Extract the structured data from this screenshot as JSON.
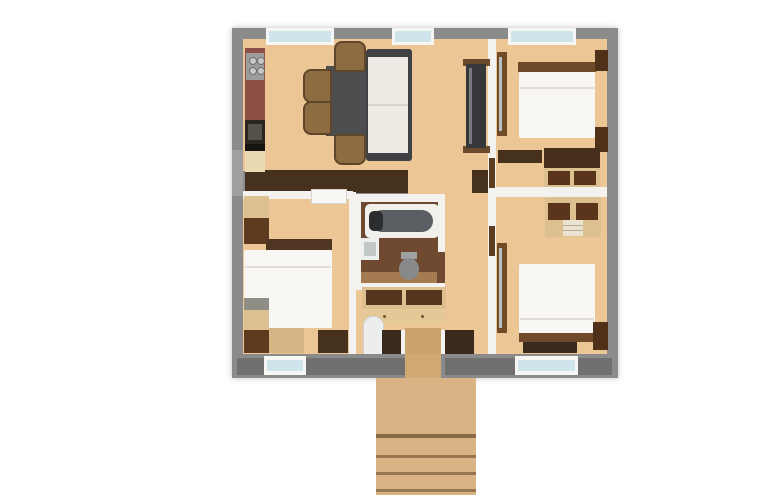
{
  "meta": {
    "image_kind": "3d-rendered-apartment-floor-plan",
    "rooms": [
      "living-dining-kitchen",
      "bedroom-top-right",
      "bedroom-bottom-right",
      "bedroom-bottom-left",
      "bathroom",
      "hallway",
      "entrance-deck"
    ]
  },
  "canvas": {
    "width": 781,
    "height": 502,
    "background": "#ffffff"
  },
  "palette": {
    "wallExt": "#8b8b8b",
    "wallInt": "#f3f2ee",
    "floorLight": "#ecc795",
    "floorBath": "#6f4a31",
    "bandDark": "#46311e",
    "woodDark": "#5e3a1f",
    "woodMid": "#8d6c42",
    "woodFrame": "#dcc08f",
    "woodDeck": "#d9b384",
    "white": "#f8f7f3",
    "glass": "#cfe3ea",
    "grayFurn": "#4b4d4f",
    "tvDark": "#35373a",
    "counterRed": "#8d5046",
    "mirror": "#b9c0c3",
    "stairLight": "#eceded"
  },
  "elements": [
    {
      "name": "exterior-wall",
      "x": 232,
      "y": 28,
      "w": 386,
      "h": 350,
      "fill": "wallExt",
      "shadow": "0 0 6px rgba(0,0,0,0.25)"
    },
    {
      "name": "left-wall-patch",
      "x": 232,
      "y": 150,
      "w": 11,
      "h": 46,
      "fill": "#a0a09e"
    },
    {
      "name": "living-room-floor",
      "x": 243,
      "y": 39,
      "w": 246,
      "h": 132,
      "fill": "floorLight",
      "tex": "planks-v"
    },
    {
      "name": "passage-living-hall-floor",
      "x": 408,
      "y": 168,
      "w": 64,
      "h": 28,
      "fill": "floorLight",
      "tex": "planks-v"
    },
    {
      "name": "corridor-floor",
      "x": 445,
      "y": 171,
      "w": 51,
      "h": 119,
      "fill": "floorLight",
      "tex": "planks-v"
    },
    {
      "name": "hall-floor",
      "x": 351,
      "y": 283,
      "w": 145,
      "h": 77,
      "fill": "floorLight",
      "tex": "planks-v"
    },
    {
      "name": "bedroom-top-right-floor",
      "x": 496,
      "y": 39,
      "w": 111,
      "h": 150,
      "fill": "floorLight",
      "tex": "planks-v"
    },
    {
      "name": "bedroom-bottom-right-floor",
      "x": 496,
      "y": 189,
      "w": 111,
      "h": 171,
      "fill": "floorLight",
      "tex": "planks-v"
    },
    {
      "name": "bedroom-bottom-left-floor",
      "x": 243,
      "y": 192,
      "w": 108,
      "h": 168,
      "fill": "floorLight",
      "tex": "planks-v"
    },
    {
      "name": "south-closet-band-living",
      "x": 245,
      "y": 170,
      "w": 163,
      "h": 23,
      "fill": "bandDark"
    },
    {
      "name": "south-closet-band-right",
      "x": 472,
      "y": 170,
      "w": 24,
      "h": 23,
      "fill": "bandDark"
    },
    {
      "name": "wall-bedroom-bottom-left-north",
      "x": 243,
      "y": 191,
      "w": 110,
      "h": 8,
      "fill": "wallInt"
    },
    {
      "name": "wall-bedroom-left-east",
      "x": 349,
      "y": 192,
      "w": 7,
      "h": 168,
      "fill": "wallInt"
    },
    {
      "name": "wall-living-east",
      "x": 488,
      "y": 39,
      "w": 8,
      "h": 321,
      "fill": "wallInt"
    },
    {
      "name": "wall-right-bedrooms-divider",
      "x": 496,
      "y": 187,
      "w": 111,
      "h": 10,
      "fill": "wallInt"
    },
    {
      "name": "kitchen-counter-tile",
      "x": 245,
      "y": 48,
      "w": 20,
      "h": 76,
      "fill": "counterRed",
      "tex": "speckle"
    },
    {
      "name": "cooktop",
      "x": 246,
      "y": 53,
      "w": 18,
      "h": 27,
      "fill": "#9d9d9b"
    },
    {
      "name": "cooktop-burner-1",
      "x": 249,
      "y": 57,
      "w": 6,
      "h": 6,
      "fill": "#c7c7c5",
      "br": "50%",
      "border": "1px solid #6e6e6c"
    },
    {
      "name": "cooktop-burner-2",
      "x": 257,
      "y": 57,
      "w": 6,
      "h": 6,
      "fill": "#c7c7c5",
      "br": "50%",
      "border": "1px solid #6e6e6c"
    },
    {
      "name": "cooktop-burner-3",
      "x": 249,
      "y": 67,
      "w": 6,
      "h": 6,
      "fill": "#c7c7c5",
      "br": "50%",
      "border": "1px solid #6e6e6c"
    },
    {
      "name": "cooktop-burner-4",
      "x": 257,
      "y": 67,
      "w": 6,
      "h": 6,
      "fill": "#c7c7c5",
      "br": "50%",
      "border": "1px solid #6e6e6c"
    },
    {
      "name": "kitchen-sink",
      "x": 245,
      "y": 120,
      "w": 20,
      "h": 24,
      "fill": "#2a2520"
    },
    {
      "name": "kitchen-sink-basin",
      "x": 248,
      "y": 124,
      "w": 14,
      "h": 16,
      "fill": "#55504a"
    },
    {
      "name": "kitchen-counter-dark",
      "x": 245,
      "y": 144,
      "w": 20,
      "h": 7,
      "fill": "#161310"
    },
    {
      "name": "kitchen-cabinet",
      "x": 245,
      "y": 151,
      "w": 20,
      "h": 21,
      "fill": "#ead9b2"
    },
    {
      "name": "dining-table",
      "x": 326,
      "y": 66,
      "w": 42,
      "h": 70,
      "fill": "grayFurn"
    },
    {
      "name": "dining-chair-top",
      "x": 334,
      "y": 41,
      "w": 28,
      "h": 27,
      "fill": "woodMid",
      "br": "8px 8px 3px 3px",
      "border": "2px solid #5f462a"
    },
    {
      "name": "dining-chair-left-1",
      "x": 303,
      "y": 69,
      "w": 25,
      "h": 30,
      "fill": "woodMid",
      "br": "8px 3px 3px 8px",
      "border": "2px solid #5f462a"
    },
    {
      "name": "dining-chair-left-2",
      "x": 303,
      "y": 101,
      "w": 25,
      "h": 30,
      "fill": "woodMid",
      "br": "8px 3px 3px 8px",
      "border": "2px solid #5f462a"
    },
    {
      "name": "dining-chair-bottom",
      "x": 334,
      "y": 134,
      "w": 28,
      "h": 27,
      "fill": "woodMid",
      "br": "3px 3px 8px 8px",
      "border": "2px solid #5f462a"
    },
    {
      "name": "sofa-frame",
      "x": 366,
      "y": 49,
      "w": 46,
      "h": 112,
      "fill": "#3f4144",
      "br": "3px"
    },
    {
      "name": "sofa-seat",
      "x": 368,
      "y": 57,
      "w": 40,
      "h": 96,
      "fill": "#edebe4"
    },
    {
      "name": "sofa-seam",
      "x": 368,
      "y": 104,
      "w": 40,
      "h": 2,
      "fill": "#d8d5cc"
    },
    {
      "name": "tv-console-shelf-top",
      "x": 463,
      "y": 59,
      "w": 27,
      "h": 7,
      "fill": "#6b4a2c"
    },
    {
      "name": "tv-console-shelf-bottom",
      "x": 463,
      "y": 146,
      "w": 27,
      "h": 7,
      "fill": "#6b4a2c"
    },
    {
      "name": "tv-console",
      "x": 466,
      "y": 64,
      "w": 20,
      "h": 84,
      "fill": "tvDark"
    },
    {
      "name": "tv-screen-glint",
      "x": 469,
      "y": 68,
      "w": 3,
      "h": 76,
      "fill": "#787c80"
    },
    {
      "name": "door-bedroom-top-right",
      "x": 489,
      "y": 158,
      "w": 6,
      "h": 30,
      "fill": "#5d3c20"
    },
    {
      "name": "door-bedroom-bottom-right",
      "x": 489,
      "y": 226,
      "w": 6,
      "h": 30,
      "fill": "#5d3c20"
    },
    {
      "name": "wardrobe-strip-top-right",
      "x": 497,
      "y": 52,
      "w": 10,
      "h": 84,
      "fill": "#6f4b28"
    },
    {
      "name": "wardrobe-mirror-top-right",
      "x": 499,
      "y": 57,
      "w": 3,
      "h": 74,
      "fill": "mirror"
    },
    {
      "name": "bed1-headboard",
      "x": 518,
      "y": 62,
      "w": 78,
      "h": 10,
      "fill": "#6f4a2a"
    },
    {
      "name": "bed1-mattress",
      "x": 519,
      "y": 72,
      "w": 76,
      "h": 66,
      "fill": "white",
      "br": "2px"
    },
    {
      "name": "bed1-pillow-seam",
      "x": 520,
      "y": 87,
      "w": 74,
      "h": 2,
      "fill": "#e0ddd4"
    },
    {
      "name": "bed1-nightstand-top",
      "x": 595,
      "y": 50,
      "w": 13,
      "h": 21,
      "fill": "#4e3118"
    },
    {
      "name": "bed1-nightstand-bottom",
      "x": 595,
      "y": 127,
      "w": 13,
      "h": 25,
      "fill": "#4e3118"
    },
    {
      "name": "cabinet-top-right-band",
      "x": 498,
      "y": 150,
      "w": 44,
      "h": 13,
      "fill": "bandDark"
    },
    {
      "name": "desk-top-right",
      "x": 544,
      "y": 148,
      "w": 56,
      "h": 20,
      "fill": "#46301c"
    },
    {
      "name": "desk-shelf-frame",
      "x": 544,
      "y": 168,
      "w": 56,
      "h": 19,
      "fill": "woodFrame"
    },
    {
      "name": "desk-shelf-left",
      "x": 548,
      "y": 171,
      "w": 22,
      "h": 14,
      "fill": "#5a341b"
    },
    {
      "name": "desk-shelf-right",
      "x": 574,
      "y": 171,
      "w": 22,
      "h": 14,
      "fill": "#5a341b"
    },
    {
      "name": "wardrobe2-frame",
      "x": 545,
      "y": 197,
      "w": 56,
      "h": 40,
      "fill": "woodFrame"
    },
    {
      "name": "wardrobe2-interior-left",
      "x": 548,
      "y": 203,
      "w": 22,
      "h": 17,
      "fill": "#5a341b"
    },
    {
      "name": "wardrobe2-interior-right",
      "x": 576,
      "y": 203,
      "w": 22,
      "h": 17,
      "fill": "#5a341b"
    },
    {
      "name": "wardrobe2-drawers",
      "x": 563,
      "y": 220,
      "w": 20,
      "h": 16,
      "fill": "#eae3d2"
    },
    {
      "name": "wardrobe2-drawer-line-1",
      "x": 563,
      "y": 225,
      "w": 20,
      "h": 1,
      "fill": "#b8ab90"
    },
    {
      "name": "wardrobe2-drawer-line-2",
      "x": 563,
      "y": 230,
      "w": 20,
      "h": 1,
      "fill": "#b8ab90"
    },
    {
      "name": "wardrobe-strip-bottom-right",
      "x": 497,
      "y": 243,
      "w": 10,
      "h": 90,
      "fill": "#6f4b28"
    },
    {
      "name": "wardrobe-mirror-bottom-right",
      "x": 499,
      "y": 248,
      "w": 3,
      "h": 80,
      "fill": "mirror"
    },
    {
      "name": "bed2-mattress",
      "x": 519,
      "y": 264,
      "w": 76,
      "h": 70,
      "fill": "white",
      "br": "2px"
    },
    {
      "name": "bed2-pillow-seam",
      "x": 520,
      "y": 318,
      "w": 74,
      "h": 2,
      "fill": "#e0ddd4"
    },
    {
      "name": "bed2-footboard",
      "x": 519,
      "y": 333,
      "w": 76,
      "h": 9,
      "fill": "#6f4a2a"
    },
    {
      "name": "bed2-bench",
      "x": 523,
      "y": 342,
      "w": 54,
      "h": 11,
      "fill": "#3a2a1c"
    },
    {
      "name": "bed2-nightstand",
      "x": 593,
      "y": 322,
      "w": 15,
      "h": 28,
      "fill": "#4e3118"
    },
    {
      "name": "wardrobe3-upper",
      "x": 244,
      "y": 196,
      "w": 25,
      "h": 22,
      "fill": "woodFrame"
    },
    {
      "name": "wardrobe3-lower",
      "x": 244,
      "y": 218,
      "w": 25,
      "h": 26,
      "fill": "#5e3a1f"
    },
    {
      "name": "door-bedroom-left",
      "x": 311,
      "y": 189,
      "w": 34,
      "h": 13,
      "fill": "white",
      "tex": "panels",
      "border": "1px solid #d9d6cf"
    },
    {
      "name": "bed3-headboard",
      "x": 266,
      "y": 239,
      "w": 66,
      "h": 11,
      "fill": "#4f3522"
    },
    {
      "name": "bed3-mattress",
      "x": 244,
      "y": 250,
      "w": 88,
      "h": 78,
      "fill": "white",
      "br": "2px"
    },
    {
      "name": "bed3-pillow-seam",
      "x": 245,
      "y": 266,
      "w": 86,
      "h": 2,
      "fill": "#e0ddd4"
    },
    {
      "name": "bed3-bench-light",
      "x": 266,
      "y": 328,
      "w": 38,
      "h": 25,
      "fill": "#d8b584"
    },
    {
      "name": "bed3-bench-dark",
      "x": 318,
      "y": 330,
      "w": 30,
      "h": 23,
      "fill": "#46311f"
    },
    {
      "name": "wardrobe4-top",
      "x": 244,
      "y": 298,
      "w": 25,
      "h": 12,
      "fill": "#8f8e86"
    },
    {
      "name": "wardrobe4-mid",
      "x": 244,
      "y": 310,
      "w": 25,
      "h": 20,
      "fill": "woodFrame"
    },
    {
      "name": "wardrobe4-low",
      "x": 244,
      "y": 330,
      "w": 25,
      "h": 23,
      "fill": "#5e3a1f"
    },
    {
      "name": "bathroom-walls",
      "x": 353,
      "y": 194,
      "w": 92,
      "h": 96,
      "fill": "wallInt"
    },
    {
      "name": "bathroom-floor",
      "x": 361,
      "y": 202,
      "w": 77,
      "h": 81,
      "fill": "floorBath",
      "tex": "planks-h"
    },
    {
      "name": "bathroom-floor-light",
      "x": 361,
      "y": 272,
      "w": 77,
      "h": 11,
      "fill": "#a57b52",
      "tex": "planks-h"
    },
    {
      "name": "bathtub",
      "x": 365,
      "y": 204,
      "w": 74,
      "h": 34,
      "fill": "#f1f0eb",
      "br": "5px"
    },
    {
      "name": "bathtub-basin",
      "x": 371,
      "y": 210,
      "w": 62,
      "h": 22,
      "fill": "#5b5e62",
      "br": "11px"
    },
    {
      "name": "bathtub-faucet",
      "x": 369,
      "y": 211,
      "w": 14,
      "h": 20,
      "fill": "#2b2d2f",
      "br": "5px"
    },
    {
      "name": "bath-sink",
      "x": 361,
      "y": 238,
      "w": 18,
      "h": 22,
      "fill": "#eef0ef"
    },
    {
      "name": "bath-sink-basin",
      "x": 364,
      "y": 242,
      "w": 12,
      "h": 14,
      "fill": "#c2c7c8"
    },
    {
      "name": "bathroom-door-opening",
      "x": 437,
      "y": 252,
      "w": 8,
      "h": 31,
      "fill": "floorBath"
    },
    {
      "name": "toilet-tank",
      "x": 401,
      "y": 252,
      "w": 16,
      "h": 7,
      "fill": "#9fa1a1"
    },
    {
      "name": "toilet",
      "x": 399,
      "y": 258,
      "w": 20,
      "h": 22,
      "fill": "#87898a",
      "br": "50%"
    },
    {
      "name": "hall-shelf-frame",
      "x": 362,
      "y": 287,
      "w": 84,
      "h": 22,
      "fill": "woodFrame"
    },
    {
      "name": "hall-shelf-left",
      "x": 366,
      "y": 290,
      "w": 36,
      "h": 15,
      "fill": "#55331c"
    },
    {
      "name": "hall-shelf-right",
      "x": 406,
      "y": 290,
      "w": 36,
      "h": 15,
      "fill": "#55331c"
    },
    {
      "name": "hall-cabinet",
      "x": 362,
      "y": 309,
      "w": 84,
      "h": 15,
      "fill": "#e6c897"
    },
    {
      "name": "hall-cabinet-knob-1",
      "x": 383,
      "y": 315,
      "w": 3,
      "h": 3,
      "fill": "#6e5436",
      "br": "50%"
    },
    {
      "name": "hall-cabinet-knob-2",
      "x": 421,
      "y": 315,
      "w": 3,
      "h": 3,
      "fill": "#6e5436",
      "br": "50%"
    },
    {
      "name": "interior-stairs",
      "x": 363,
      "y": 316,
      "w": 19,
      "h": 41,
      "fill": "stairLight",
      "tex": "treads",
      "br": "10px 10px 0 0",
      "border": "1px solid #cfd1d2"
    },
    {
      "name": "entry-vestibule-band",
      "x": 382,
      "y": 330,
      "w": 92,
      "h": 28,
      "fill": "#3a2a1b"
    },
    {
      "name": "entry-threshold",
      "x": 405,
      "y": 328,
      "w": 36,
      "h": 30,
      "fill": "#caa36f",
      "tex": "planks-v"
    },
    {
      "name": "entry-jamb-left",
      "x": 401,
      "y": 330,
      "w": 4,
      "h": 28,
      "fill": "wallInt"
    },
    {
      "name": "entry-jamb-right",
      "x": 441,
      "y": 330,
      "w": 4,
      "h": 28,
      "fill": "wallInt"
    },
    {
      "name": "window-top-1-frame",
      "x": 266,
      "y": 28,
      "w": 68,
      "h": 17,
      "fill": "#f6f6f4"
    },
    {
      "name": "window-top-1-glass",
      "x": 269,
      "y": 31,
      "w": 62,
      "h": 11,
      "fill": "glass",
      "tex": "glass2"
    },
    {
      "name": "window-top-2-frame",
      "x": 392,
      "y": 28,
      "w": 42,
      "h": 17,
      "fill": "#f6f6f4"
    },
    {
      "name": "window-top-2-glass",
      "x": 395,
      "y": 31,
      "w": 36,
      "h": 11,
      "fill": "glass",
      "tex": "glass2"
    },
    {
      "name": "window-top-3-frame",
      "x": 508,
      "y": 28,
      "w": 68,
      "h": 17,
      "fill": "#f6f6f4"
    },
    {
      "name": "window-top-3-glass",
      "x": 511,
      "y": 31,
      "w": 62,
      "h": 11,
      "fill": "glass",
      "tex": "glass2"
    },
    {
      "name": "bottom-wall",
      "x": 232,
      "y": 354,
      "w": 386,
      "h": 24,
      "fill": "wallExt"
    },
    {
      "name": "bottom-wall-cladding-1",
      "x": 237,
      "y": 358,
      "w": 27,
      "h": 17,
      "fill": "#707070",
      "tex": "stripes-wall"
    },
    {
      "name": "bottom-wall-cladding-2",
      "x": 306,
      "y": 358,
      "w": 100,
      "h": 17,
      "fill": "#707070",
      "tex": "stripes-wall"
    },
    {
      "name": "bottom-wall-cladding-3",
      "x": 445,
      "y": 358,
      "w": 70,
      "h": 17,
      "fill": "#707070",
      "tex": "stripes-wall"
    },
    {
      "name": "bottom-wall-cladding-4",
      "x": 578,
      "y": 358,
      "w": 34,
      "h": 17,
      "fill": "#707070",
      "tex": "stripes-wall"
    },
    {
      "name": "window-bottom-1-frame",
      "x": 264,
      "y": 356,
      "w": 42,
      "h": 19,
      "fill": "#f6f6f4"
    },
    {
      "name": "window-bottom-1-glass",
      "x": 267,
      "y": 360,
      "w": 36,
      "h": 11,
      "fill": "glass",
      "tex": "glass2"
    },
    {
      "name": "window-bottom-2-frame",
      "x": 515,
      "y": 356,
      "w": 63,
      "h": 19,
      "fill": "#f6f6f4"
    },
    {
      "name": "window-bottom-2-glass",
      "x": 518,
      "y": 360,
      "w": 57,
      "h": 11,
      "fill": "glass",
      "tex": "glass2"
    },
    {
      "name": "entry-door-gap",
      "x": 405,
      "y": 354,
      "w": 36,
      "h": 24,
      "fill": "#cfa873"
    },
    {
      "name": "entry-deck",
      "x": 376,
      "y": 378,
      "w": 100,
      "h": 117,
      "fill": "woodDeck",
      "tex": "planks-v"
    },
    {
      "name": "deck-step-edge-1",
      "x": 376,
      "y": 434,
      "w": 100,
      "h": 4,
      "fill": "rgba(70,45,20,0.55)"
    },
    {
      "name": "deck-step-edge-2",
      "x": 376,
      "y": 455,
      "w": 100,
      "h": 3,
      "fill": "rgba(70,45,20,0.45)"
    },
    {
      "name": "deck-step-edge-3",
      "x": 376,
      "y": 472,
      "w": 100,
      "h": 3,
      "fill": "rgba(70,45,20,0.45)"
    },
    {
      "name": "deck-step-edge-4",
      "x": 376,
      "y": 489,
      "w": 100,
      "h": 3,
      "fill": "rgba(70,45,20,0.45)"
    }
  ]
}
